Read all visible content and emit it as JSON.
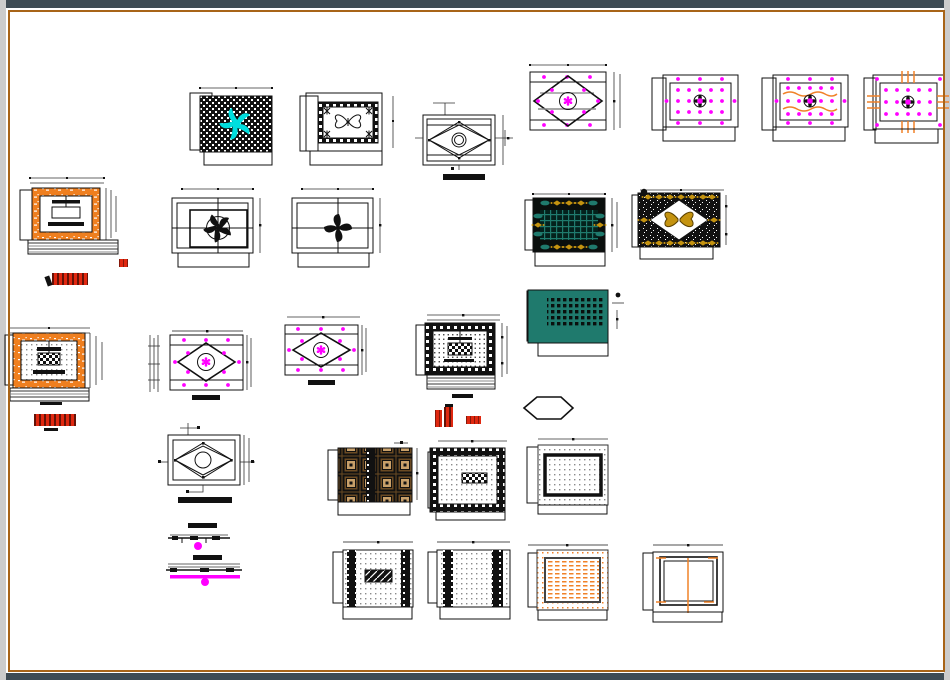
{
  "meta": {
    "app_title": "CAD drawing sheet — false ceiling designs",
    "sheet_note": "no legible text labels; red title stamps are unreadable raster text"
  },
  "palette": {
    "pageBg": "#ffffff",
    "chromeDark": "#3e4b54",
    "frameOrange": "#a86418",
    "edgeGray": "#cccccc",
    "magenta": "#ff00ff",
    "cyan": "#00dede",
    "teal": "#1f7a6d",
    "tealDark": "#0d4f45",
    "gold": "#c49310",
    "orange": "#f08228",
    "orangeFill": "#ef7f1f",
    "brown": "#6b4a23",
    "tan": "#c8a06a",
    "red": "#e02810"
  },
  "panels": [
    {
      "name": "checkered-fan-ceiling",
      "desc": "black checkerboard ceiling with cyan swirl fan"
    },
    {
      "name": "butterfly-border-ceiling",
      "desc": "dark patterned border, butterfly motif center"
    },
    {
      "name": "diamond-detail-plan",
      "desc": "line plan with diamond, circle and leaders"
    },
    {
      "name": "dotted-diamond-ceiling",
      "desc": "magenta dotted plan with diamond and flower hub"
    },
    {
      "name": "pop-fan-ceiling-a",
      "desc": "dotted ceiling with fan hub"
    },
    {
      "name": "pop-fan-ceiling-wavy",
      "desc": "dotted ceiling with fan hub and orange waves"
    },
    {
      "name": "pop-fan-ceiling-ticks",
      "desc": "dotted ceiling with fan hub and orange ticks"
    },
    {
      "name": "orange-frame-elevation",
      "desc": "orange border unit elevation with section lines"
    },
    {
      "name": "ceiling-fan-plan-a",
      "desc": "bordered plan with round-blade ceiling fan"
    },
    {
      "name": "ceiling-fan-plan-b",
      "desc": "bordered plan with pinwheel ceiling fan"
    },
    {
      "name": "teal-grid-ceiling",
      "desc": "black panel, teal grid center, gold ornament border"
    },
    {
      "name": "gold-diamond-ceiling",
      "desc": "speckled panel, white diamond with gold butterfly"
    },
    {
      "name": "orange-dotted-ceiling",
      "desc": "orange frame, dotted field, checkered hub"
    },
    {
      "name": "dotted-diamond-plan-a",
      "desc": "dotted diamond ceiling plan"
    },
    {
      "name": "dotted-diamond-plan-b",
      "desc": "dotted diamond ceiling plan"
    },
    {
      "name": "black-border-ceiling",
      "desc": "black ornate border, dotted field, checkered hub"
    },
    {
      "name": "teal-panel-ceiling",
      "desc": "teal slab with black stud grid"
    },
    {
      "name": "diamond-leader-plan",
      "desc": "diamond plan with leader arrows"
    },
    {
      "name": "hexagon-detail",
      "desc": "hexagon outline detail"
    },
    {
      "name": "coffered-ceiling",
      "desc": "brown coffered grid ceiling"
    },
    {
      "name": "greek-key-ceiling",
      "desc": "ornate black border with checkered center"
    },
    {
      "name": "inner-frame-ceiling",
      "desc": "dotted panel with heavy inner frame"
    },
    {
      "name": "ceiling-sections",
      "desc": "two thin ceiling cross-sections with magenta drops"
    },
    {
      "name": "side-band-ceiling",
      "desc": "dotted panel, ornate side bands, hatched center"
    },
    {
      "name": "four-band-ceiling",
      "desc": "dotted panel with two ornate band pairs"
    },
    {
      "name": "orange-hatch-ceiling",
      "desc": "orange hatched panel in frame"
    },
    {
      "name": "plain-frame-ceiling",
      "desc": "nested frames with orange centerline"
    }
  ],
  "stamps": [
    {
      "name": "red-title-stamp-1",
      "desc": "unreadable red plot-stamp text"
    },
    {
      "name": "red-marker",
      "desc": "small red square marker"
    },
    {
      "name": "red-title-stamp-2",
      "desc": "unreadable red plot-stamp text"
    },
    {
      "name": "red-title-stamp-3",
      "desc": "unreadable red plot-stamp blocks"
    }
  ]
}
